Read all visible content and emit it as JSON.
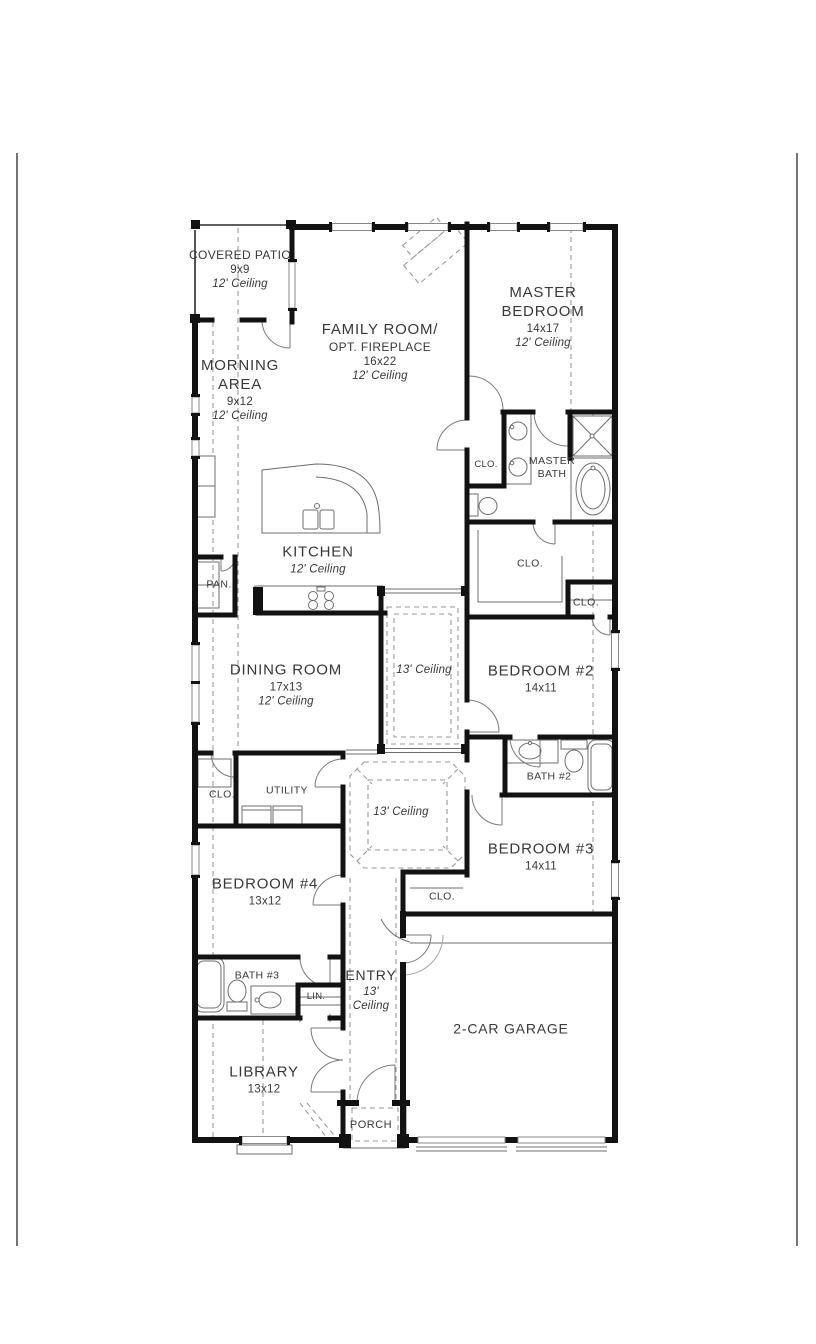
{
  "style": {
    "wall_color": "#121212",
    "text_color": "#383838",
    "thin_line_color": "#6e6e6e",
    "dash_color": "#9a9a9a",
    "background": "#ffffff"
  },
  "rooms": {
    "covered_patio": {
      "name": "COVERED PATIO",
      "dims": "9x9",
      "ceiling": "12' Ceiling"
    },
    "family_room": {
      "name": "FAMILY ROOM/",
      "subname": "OPT. FIREPLACE",
      "dims": "16x22",
      "ceiling": "12' Ceiling"
    },
    "master_bedroom": {
      "name": "MASTER",
      "name2": "BEDROOM",
      "dims": "14x17",
      "ceiling": "12' Ceiling"
    },
    "morning_area": {
      "name": "MORNING",
      "name2": "AREA",
      "dims": "9x12",
      "ceiling": "12' Ceiling"
    },
    "kitchen": {
      "name": "KITCHEN",
      "ceiling": "12' Ceiling"
    },
    "pantry": {
      "name": "PAN."
    },
    "master_bath": {
      "name": "MASTER",
      "name2": "BATH"
    },
    "bath_hall_closet": {
      "name": "CLO."
    },
    "master_closet": {
      "name": "CLO."
    },
    "bedroom2_closet": {
      "name": "CLO."
    },
    "dining_room": {
      "name": "DINING ROOM",
      "dims": "17x13",
      "ceiling": "12' Ceiling"
    },
    "gallery": {
      "ceiling": "13' Ceiling"
    },
    "bedroom2": {
      "name": "BEDROOM #2",
      "dims": "14x11"
    },
    "bath2": {
      "name": "BATH #2"
    },
    "utility": {
      "name": "UTILITY"
    },
    "bedroom4_closet": {
      "name": "CLO."
    },
    "hall": {
      "ceiling": "13' Ceiling"
    },
    "bedroom4": {
      "name": "BEDROOM #4",
      "dims": "13x12"
    },
    "bedroom3": {
      "name": "BEDROOM #3",
      "dims": "14x11"
    },
    "bedroom3_closet": {
      "name": "CLO."
    },
    "bath3": {
      "name": "BATH #3"
    },
    "linen": {
      "name": "LIN."
    },
    "entry": {
      "name": "ENTRY",
      "ceiling_line1": "13'",
      "ceiling_line2": "Ceiling"
    },
    "library": {
      "name": "LIBRARY",
      "dims": "13x12"
    },
    "garage": {
      "name": "2-CAR GARAGE"
    },
    "porch": {
      "name": "PORCH"
    }
  }
}
